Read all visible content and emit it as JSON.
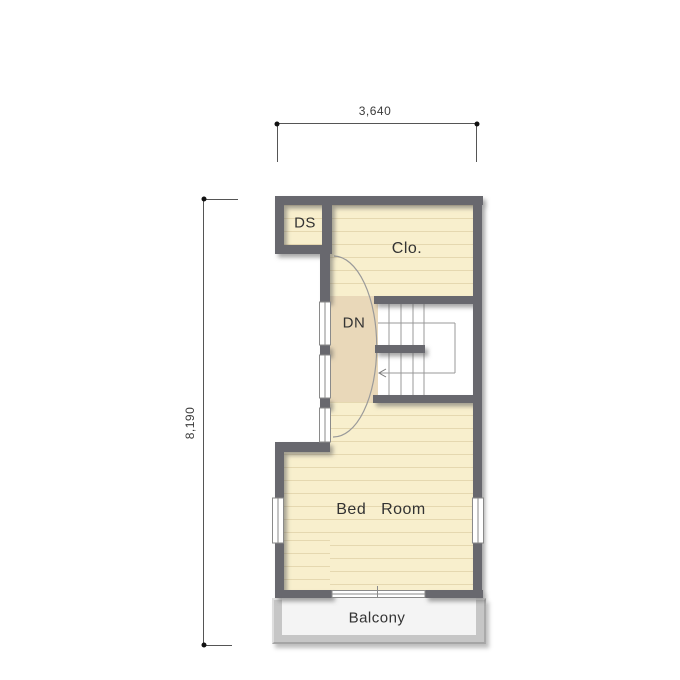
{
  "plan": {
    "rooms": {
      "ds": {
        "label": "DS"
      },
      "closet": {
        "label": "Clo."
      },
      "stairs": {
        "label": "DN"
      },
      "bedroom": {
        "label": "Bed   Room"
      },
      "balcony": {
        "label": "Balcony"
      }
    },
    "dimensions": {
      "width": "3,640",
      "height": "8,190"
    },
    "colors": {
      "wall": "#67676e",
      "floor_cream": "#f8efcd",
      "floor_stripe": "#e8dcb5",
      "hall_floor_tan": "#e9d8b9",
      "stair_floor": "#ffffff",
      "balcony_wall": "#c6c6c6",
      "balcony_floor": "#f4f4f4",
      "window_fill": "#ffffff",
      "thin_line": "#8f8f8f",
      "dimension_line": "#555555"
    }
  }
}
